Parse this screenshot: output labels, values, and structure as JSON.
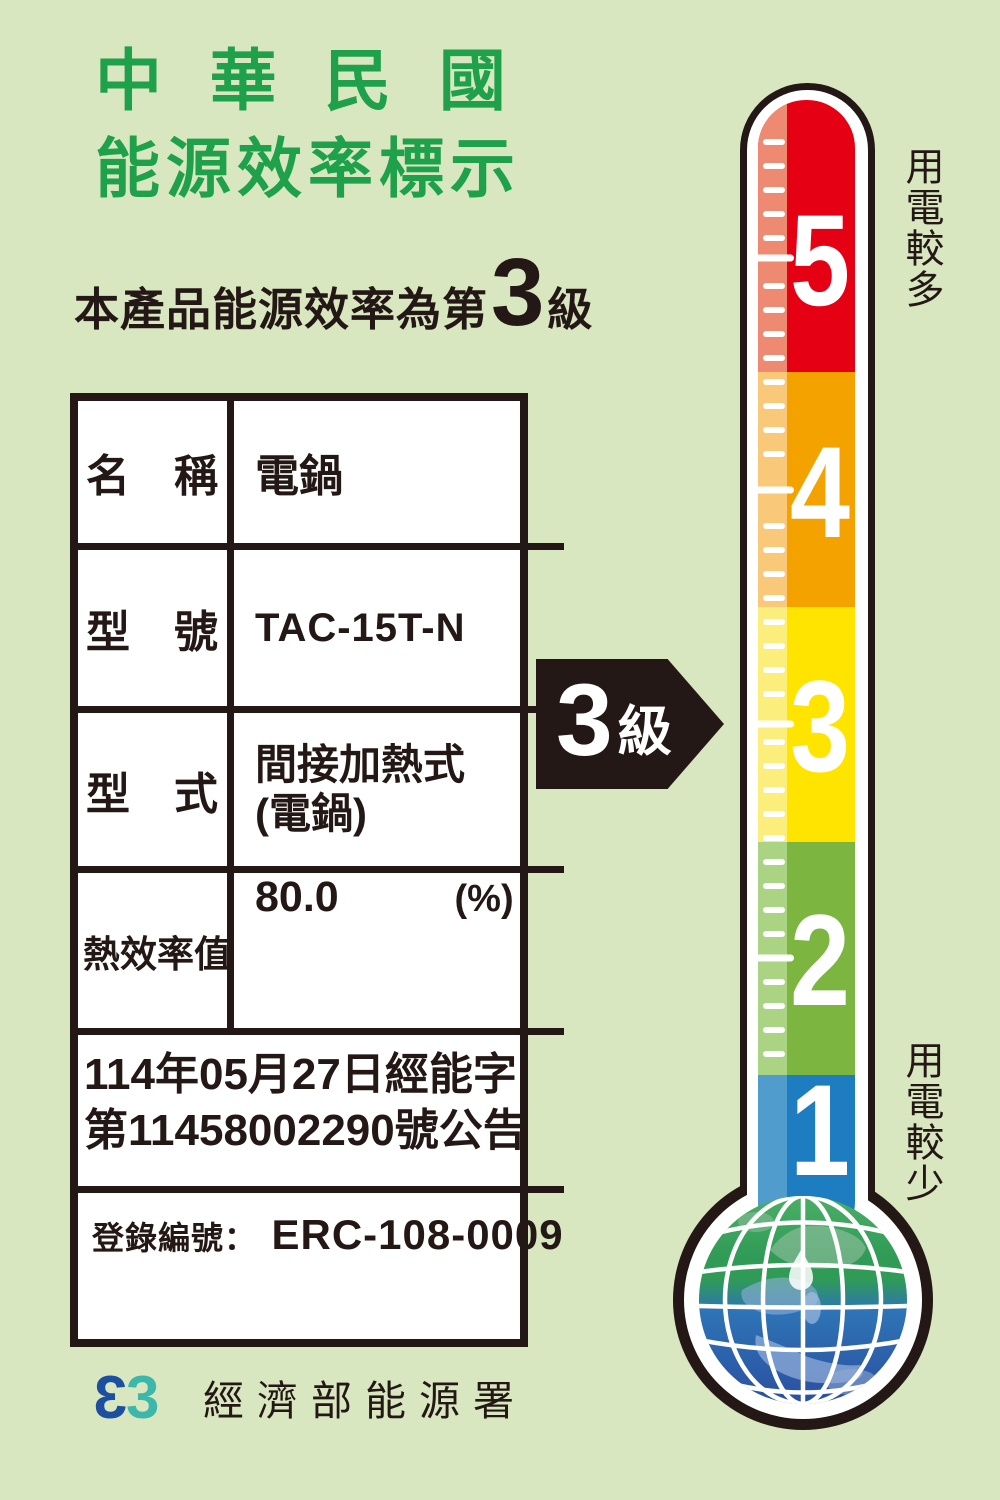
{
  "title": {
    "line1": "中 華 民 國",
    "line2": "能源效率標示"
  },
  "subtitle": {
    "prefix": "本產品能源效率為第",
    "grade": "3",
    "suffix": "級"
  },
  "table": {
    "rows": [
      {
        "label": "名　稱",
        "value": "電鍋"
      },
      {
        "label": "型　號",
        "value": "TAC-15T-N"
      },
      {
        "label": "型　式",
        "value_line1": "間接加熱式",
        "value_line2": "(電鍋)"
      },
      {
        "label": "熱效率值",
        "value": "80.0",
        "unit": "(%)"
      }
    ],
    "announcement_line1": "114年05月27日經能字",
    "announcement_line2": "第11458002290號公告",
    "registration_label": "登錄編號：",
    "registration_value": "ERC-108-0009"
  },
  "grade_arrow": {
    "number": "3",
    "suffix": "級"
  },
  "thermometer": {
    "label_top": "用電較多",
    "label_bottom": "用電較少",
    "levels": [
      {
        "value": "5",
        "color": "#e60013",
        "strip": "#ee8a72"
      },
      {
        "value": "4",
        "color": "#f4a200",
        "strip": "#f9c879"
      },
      {
        "value": "3",
        "color": "#ffe400",
        "strip": "#fbee7d"
      },
      {
        "value": "2",
        "color": "#7cb53f",
        "strip": "#aad383"
      },
      {
        "value": "1",
        "color": "#1d7dc0",
        "strip": "#4f9ccd"
      }
    ]
  },
  "footer": {
    "logo_glyph": "3",
    "agency": "經濟部能源署"
  },
  "colors": {
    "background": "#d9e7c0",
    "ink": "#231815",
    "title_green": "#1fa14c",
    "logo_blue": "#1d4fa0",
    "logo_teal": "#3cb8ab"
  }
}
